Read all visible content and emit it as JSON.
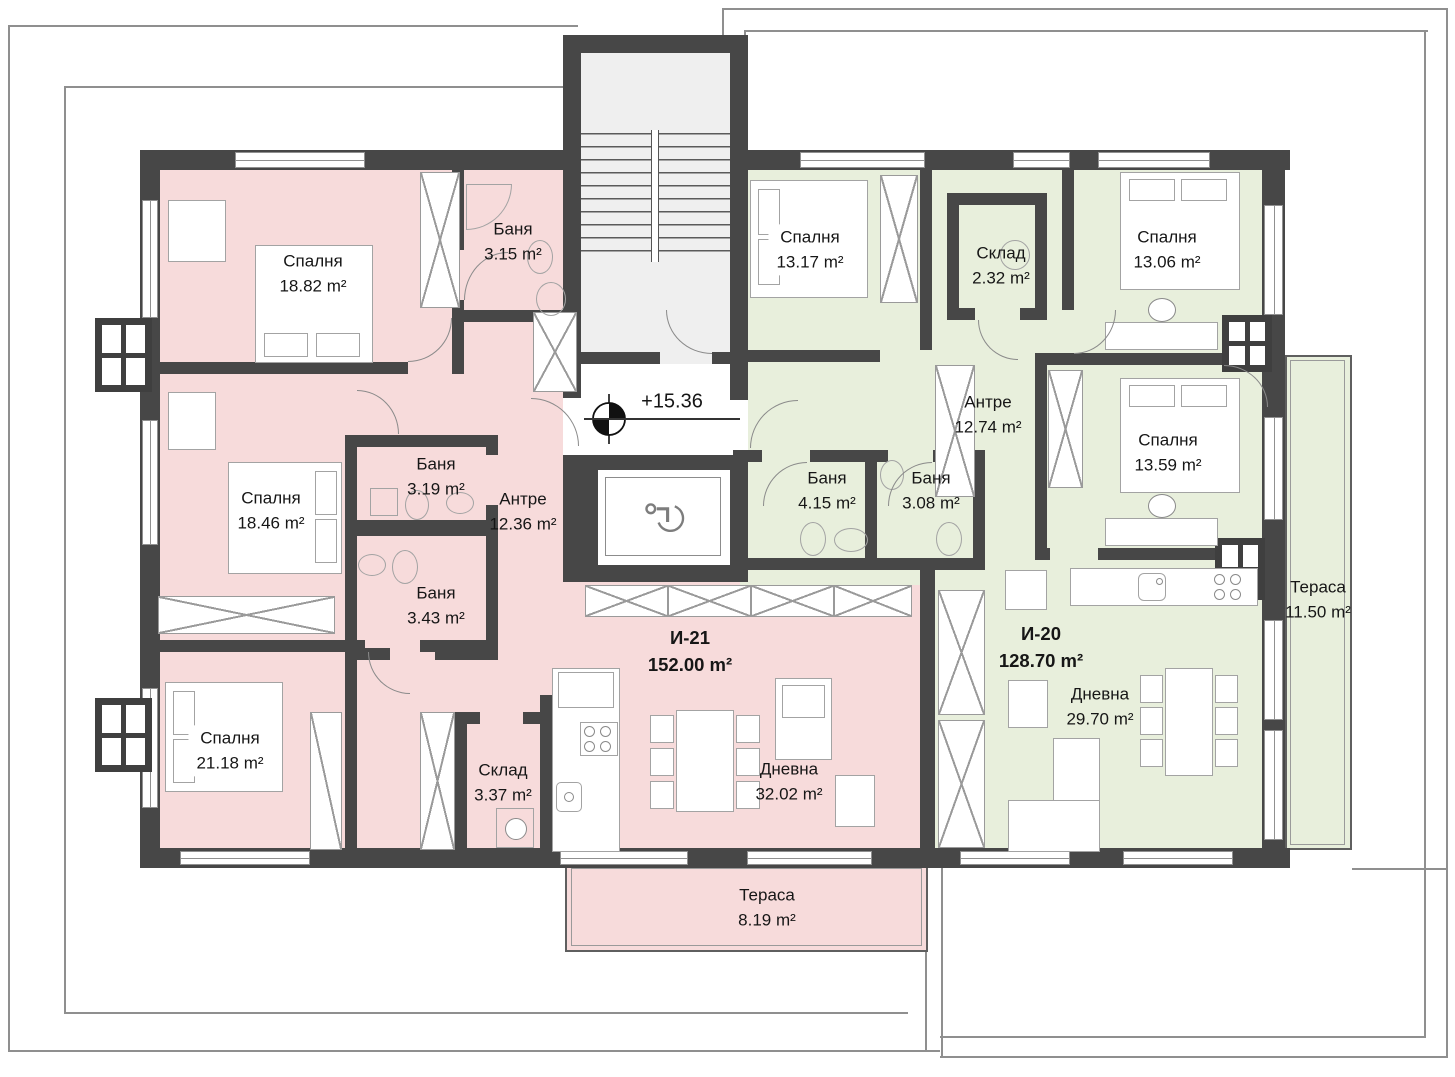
{
  "elevation": {
    "value": "+15.36"
  },
  "unit": "m²",
  "apartments": [
    {
      "id": "И-21",
      "area": "152.00 m²"
    },
    {
      "id": "И-20",
      "area": "128.70 m²"
    }
  ],
  "rooms": [
    {
      "name": "Спалня",
      "area": "18.82 m²"
    },
    {
      "name": "Баня",
      "area": "3.15 m²"
    },
    {
      "name": "Спалня",
      "area": "13.17 m²"
    },
    {
      "name": "Склад",
      "area": "2.32 m²"
    },
    {
      "name": "Спалня",
      "area": "13.06 m²"
    },
    {
      "name": "Антре",
      "area": "12.74 m²"
    },
    {
      "name": "Спалня",
      "area": "13.59 m²"
    },
    {
      "name": "Баня",
      "area": "3.19 m²"
    },
    {
      "name": "Антре",
      "area": "12.36 m²"
    },
    {
      "name": "Баня",
      "area": "4.15 m²"
    },
    {
      "name": "Баня",
      "area": "3.08 m²"
    },
    {
      "name": "Спалня",
      "area": "18.46 m²"
    },
    {
      "name": "Баня",
      "area": "3.43 m²"
    },
    {
      "name": "Тераса",
      "area": "11.50 m²"
    },
    {
      "name": "Спалня",
      "area": "21.18 m²"
    },
    {
      "name": "Склад",
      "area": "3.37 m²"
    },
    {
      "name": "Дневна",
      "area": "32.02 m²"
    },
    {
      "name": "Дневна",
      "area": "29.70 m²"
    },
    {
      "name": "Тераса",
      "area": "8.19 m²"
    }
  ],
  "colors": {
    "apartment_i21_fill": "#f7dbdb",
    "apartment_i20_fill": "#e8efdc",
    "wall": "#474747",
    "boundary_line": "#8f8f8f"
  },
  "icons": {
    "benchmark": "survey-benchmark-icon",
    "wheelchair": "wheelchair-icon"
  }
}
